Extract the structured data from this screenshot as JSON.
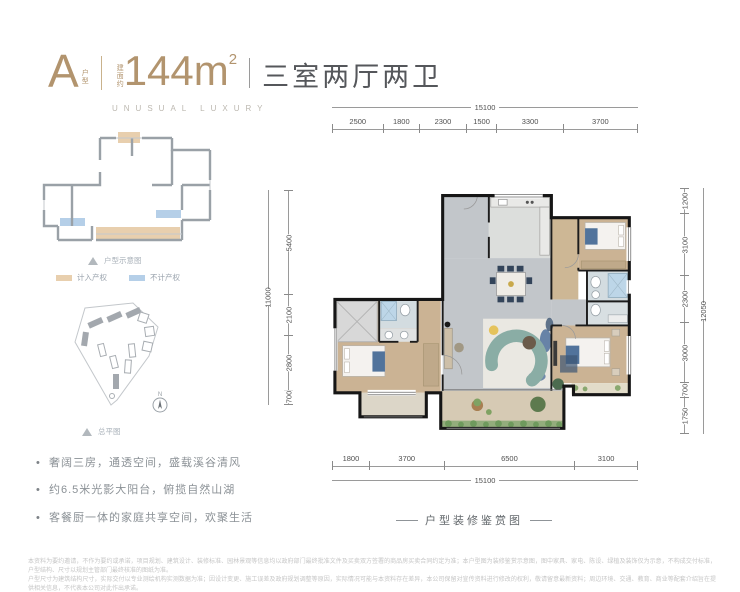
{
  "header": {
    "type_letter": "A",
    "type_label_chars": [
      "户",
      "型"
    ],
    "area_prefix_chars": [
      "建",
      "面",
      "约"
    ],
    "area_value": "144m",
    "area_sup": "2",
    "rooms": "三室两厅两卫",
    "subtitle": "UNUSUAL LUXURY",
    "accent_color": "#b2946e"
  },
  "mini_plan": {
    "caption": "户型示意图",
    "legend": [
      {
        "label": "计入产权",
        "color": "#e8cfae"
      },
      {
        "label": "不计产权",
        "color": "#b5cfe8"
      }
    ]
  },
  "site_plan": {
    "caption": "总平图",
    "compass_label": "N"
  },
  "features": [
    "奢阔三房，通透空间，盛载溪谷清风",
    "约6.5米光影大阳台，俯揽自然山湖",
    "客餐厨一体的家庭共享空间，欢聚生活"
  ],
  "dimensions": {
    "top": {
      "total": "15100",
      "segments": [
        "2500",
        "1800",
        "2300",
        "1500",
        "3300",
        "3700"
      ]
    },
    "bottom": {
      "total": "15100",
      "segments": [
        "1800",
        "3700",
        "6500",
        "3100"
      ]
    },
    "left": {
      "total": "11000",
      "segments": [
        "5400",
        "2100",
        "2800",
        "700"
      ]
    },
    "right": {
      "total": "12050",
      "segments": [
        "1200",
        "3100",
        "2300",
        "3000",
        "700",
        "1750"
      ]
    }
  },
  "plan_caption": "户型装修鉴赏图",
  "disclaimer_lines": [
    "本资料为要约邀请，不作为要约或承诺，项目规划、建筑设计、装修标准、园林景观等信息均以政府部门最终批准文件及买卖双方签署的商品房买卖合同约定为准；本户型图为装修鉴赏示意图，图中家具、家电、陈设、绿植及装饰仅为示意，不构成交付标准，户型结构、尺寸以规划主管部门最终核准的图纸为准。",
    "户型尺寸为建筑结构尺寸，实际交付以专业测绘机构实测数据为准；因设计变更、施工误差及政府规划调整等原因，实际情况可能与本资料存在差异，本公司保留对宣传资料进行修改的权利，敬请留意最新资料；周边环境、交通、教育、商业等配套介绍旨在提供相关信息，不代表本公司对此作出承诺。",
    "鉴赏图中部分设施设备为非交付标准，具体以商品房买卖合同及其附件约定为准。本宣传资料制作时间为2021年，广告有效期30天，敬请关注最新信息，详情请详询销售中心。"
  ]
}
